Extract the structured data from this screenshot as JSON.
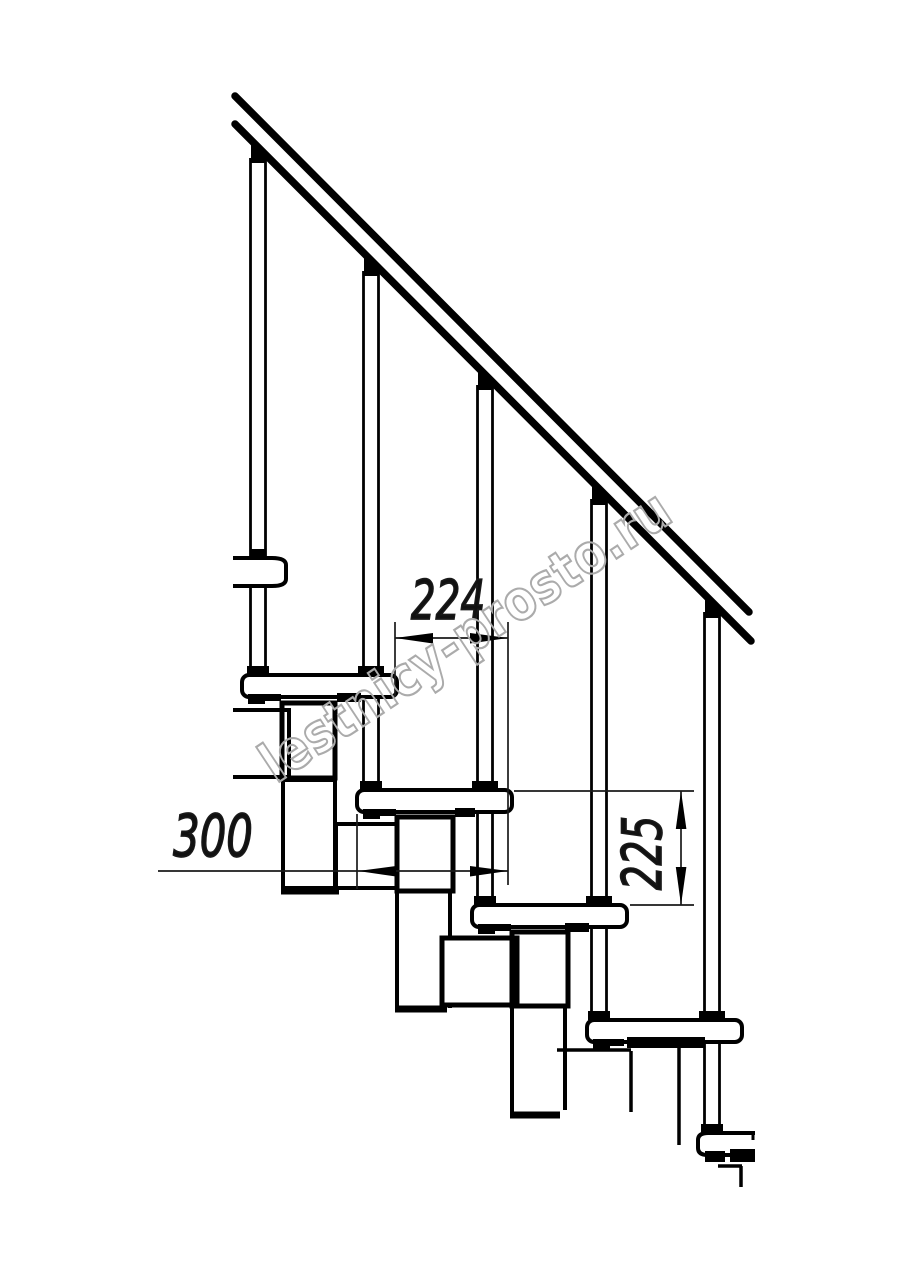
{
  "drawing": {
    "watermark": "lestnicy-prosto.ru",
    "dimensions": {
      "step_run": {
        "value": "224"
      },
      "tread_depth": {
        "value": "300"
      },
      "step_rise": {
        "value": "225"
      }
    },
    "colors": {
      "ink": "#000000",
      "dimension_ink": "#1a1a1a",
      "watermark_outline": "#ababab",
      "background": "#ffffff"
    }
  }
}
